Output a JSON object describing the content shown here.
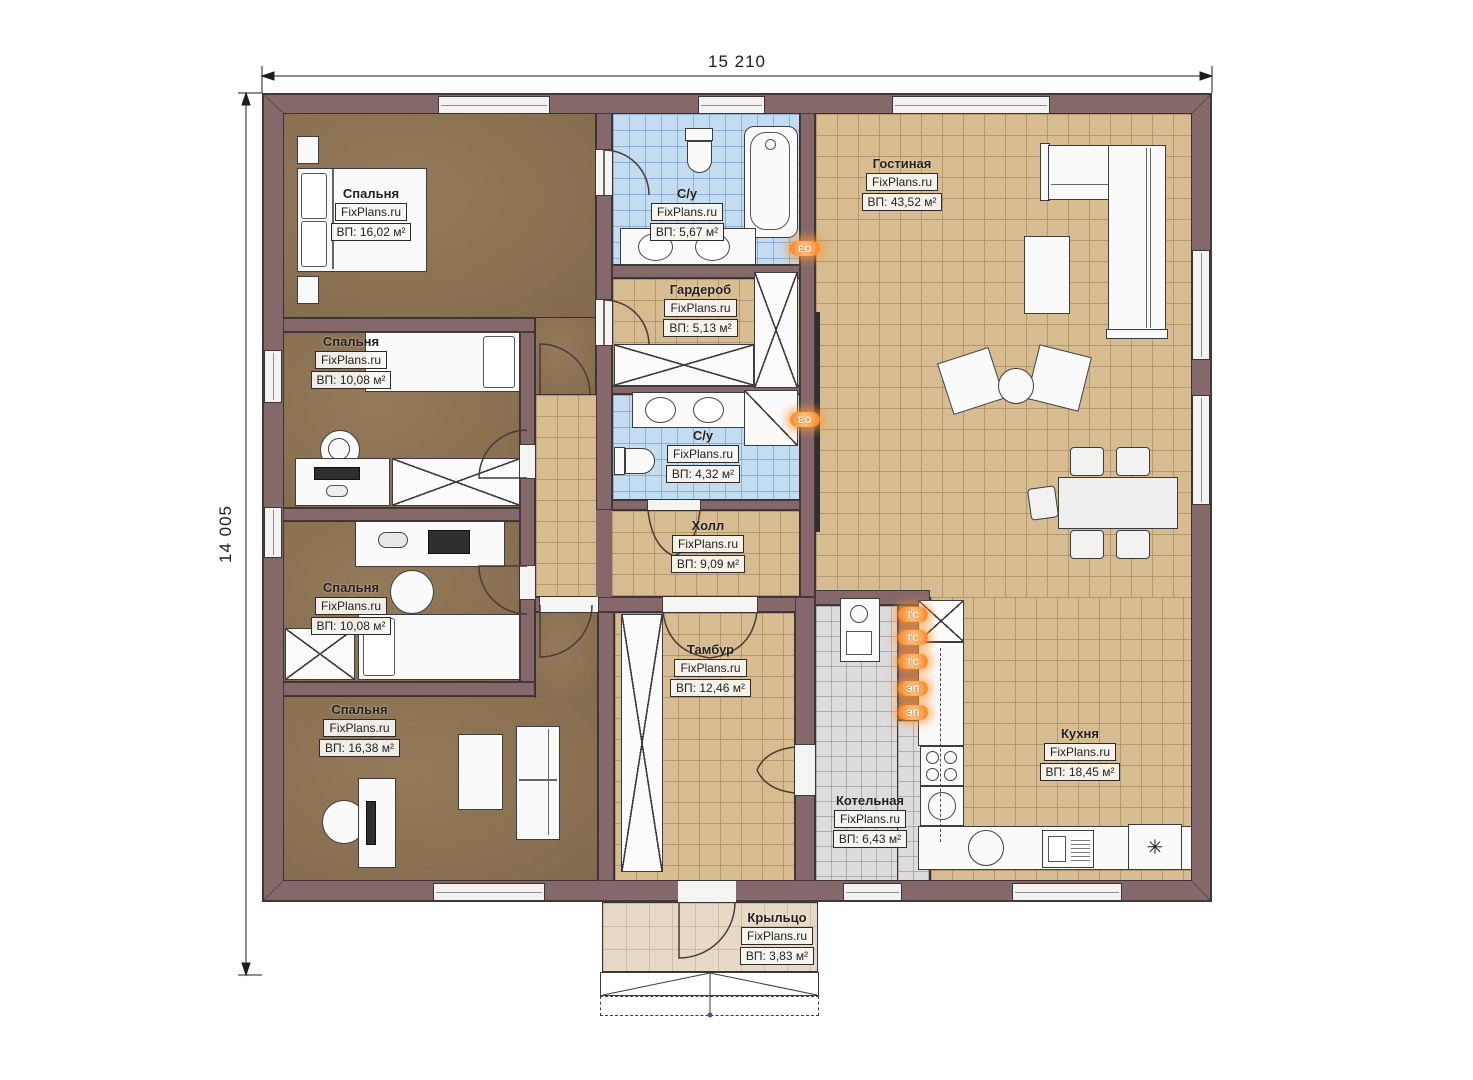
{
  "plan_title": "floor-plan",
  "dimensions": {
    "width_label": "15 210",
    "height_label": "14 005"
  },
  "watermark": "FixPlans.ru",
  "rooms": [
    {
      "id": "bedroom-1",
      "name": "Спальня",
      "area": "ВП: 16,02 м²"
    },
    {
      "id": "bedroom-2",
      "name": "Спальня",
      "area": "ВП: 10,08 м²"
    },
    {
      "id": "bedroom-3",
      "name": "Спальня",
      "area": "ВП: 10,08 м²"
    },
    {
      "id": "bedroom-4",
      "name": "Спальня",
      "area": "ВП: 16,38 м²"
    },
    {
      "id": "bathroom-1",
      "name": "С/у",
      "area": "ВП: 5,67 м²"
    },
    {
      "id": "wardrobe",
      "name": "Гардероб",
      "area": "ВП: 5,13 м²"
    },
    {
      "id": "bathroom-2",
      "name": "С/у",
      "area": "ВП: 4,32 м²"
    },
    {
      "id": "hall",
      "name": "Холл",
      "area": "ВП: 9,09 м²"
    },
    {
      "id": "tambour",
      "name": "Тамбур",
      "area": "ВП: 12,46 м²"
    },
    {
      "id": "living",
      "name": "Гостиная",
      "area": "ВП: 43,52 м²"
    },
    {
      "id": "kitchen",
      "name": "Кухня",
      "area": "ВП: 18,45 м²"
    },
    {
      "id": "boiler",
      "name": "Котельная",
      "area": "ВП: 6,43 м²"
    },
    {
      "id": "porch",
      "name": "Крыльцо",
      "area": "ВП: 3,83 м²"
    }
  ],
  "equipment_icons": {
    "towel_dryer": "ЕО",
    "heat_supply": "ТС",
    "electric_panel": "ЭП",
    "fridge_symbol": "✳"
  },
  "colors": {
    "wall": "#84686a",
    "bedroom_floor": "#8c7454",
    "tile_beige": "#d6bc90",
    "tile_blue": "#c3dcf0",
    "tile_gray": "#dcdcdc",
    "porch": "#e7d9c6",
    "accent_orange": "#ff8c2a"
  }
}
